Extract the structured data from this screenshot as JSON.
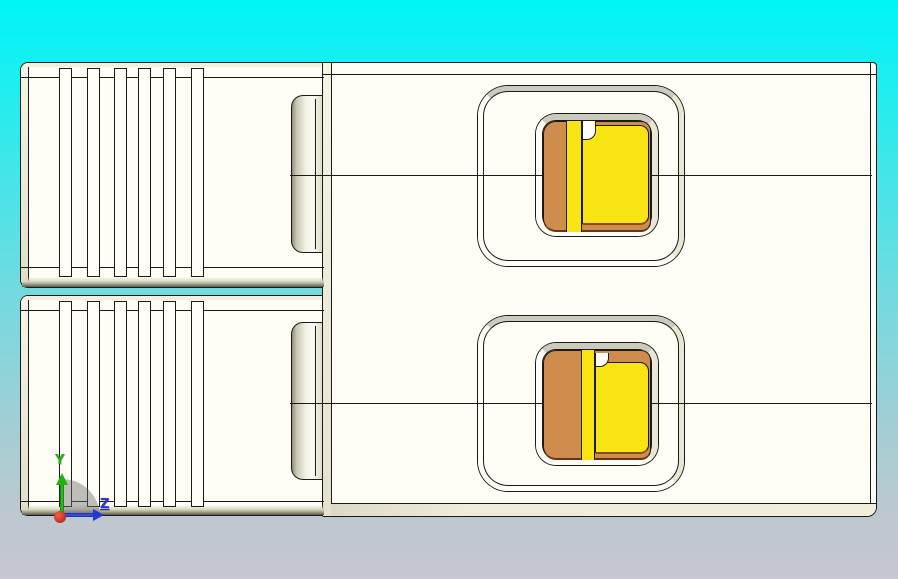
{
  "triad": {
    "y_label": "Y",
    "z_label": "Z",
    "axis_colors": {
      "x": "#c42014",
      "y": "#1bb512",
      "z": "#2438d6"
    }
  },
  "colors": {
    "background_top": "#00f5f6",
    "background_bottom": "#c7c6d2",
    "model_body": "#fefef6",
    "edge_line": "#1a1a1a",
    "side_face_beige": "#eae7d4",
    "top_face_gray": "#cbcabd",
    "contact_orange": "#ce8c4e",
    "contact_yellow": "#f7e412"
  }
}
